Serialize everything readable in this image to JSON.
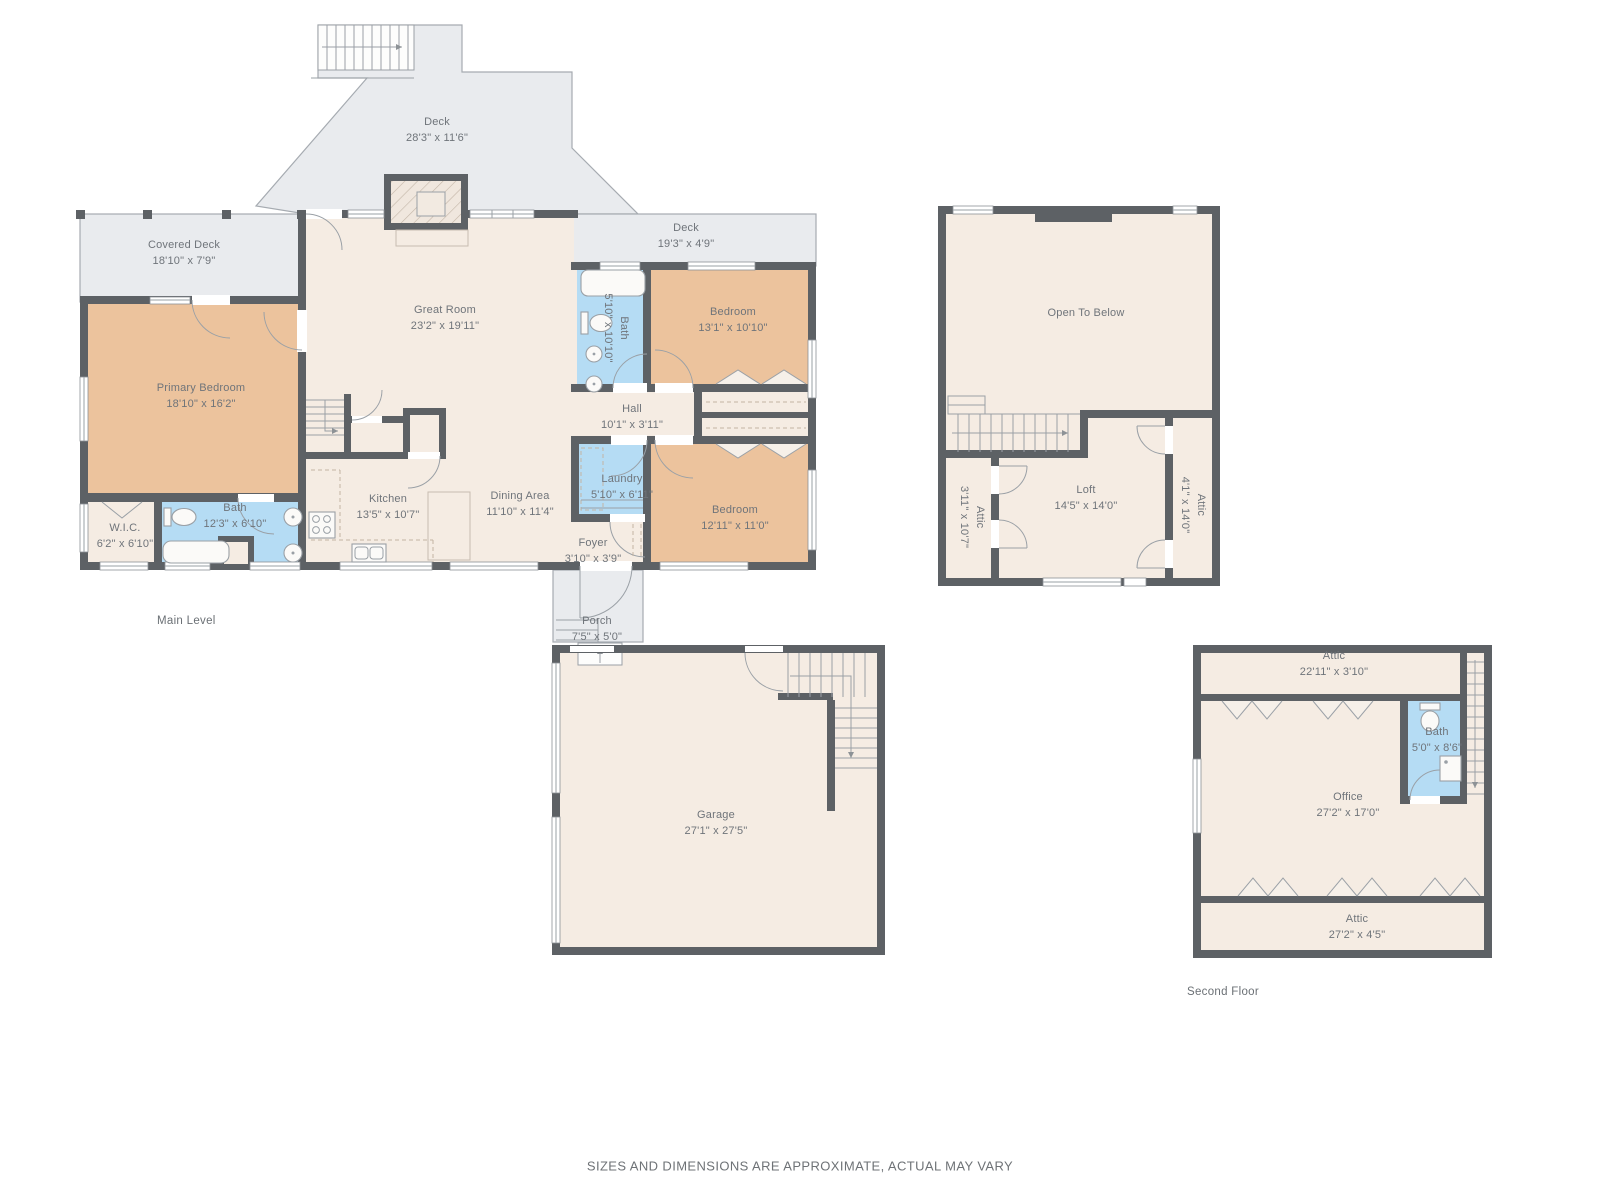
{
  "palette": {
    "wall": "#5d6165",
    "room_fill": "#f5ece3",
    "bedroom_fill": "#ecc39d",
    "bath_fill": "#b5dcf4",
    "deck_fill": "#e9ebee",
    "line": "#9aa0a6",
    "label_text": "#6f747a"
  },
  "plans": {
    "main": {
      "level_label": "Main Level",
      "rooms": {
        "deck_top": {
          "name": "Deck",
          "dims": "28'3\" x 11'6\""
        },
        "deck_right": {
          "name": "Deck",
          "dims": "19'3\" x 4'9\""
        },
        "covered_deck": {
          "name": "Covered Deck",
          "dims": "18'10\" x 7'9\""
        },
        "primary_bedroom": {
          "name": "Primary Bedroom",
          "dims": "18'10\" x 16'2\""
        },
        "great_room": {
          "name": "Great Room",
          "dims": "23'2\" x 19'11\""
        },
        "hall_bath": {
          "name": "Bath",
          "dims": "5'10\" x 10'10\""
        },
        "bedroom_top": {
          "name": "Bedroom",
          "dims": "13'1\" x 10'10\""
        },
        "hall": {
          "name": "Hall",
          "dims": "10'1\" x 3'11\""
        },
        "wic": {
          "name": "W.I.C.",
          "dims": "6'2\" x 6'10\""
        },
        "primary_bath": {
          "name": "Bath",
          "dims": "12'3\" x 6'10\""
        },
        "kitchen": {
          "name": "Kitchen",
          "dims": "13'5\" x 10'7\""
        },
        "dining": {
          "name": "Dining Area",
          "dims": "11'10\" x 11'4\""
        },
        "laundry": {
          "name": "Laundry",
          "dims": "5'10\" x 6'11\""
        },
        "bedroom_bottom": {
          "name": "Bedroom",
          "dims": "12'11\" x 11'0\""
        },
        "foyer": {
          "name": "Foyer",
          "dims": "3'10\" x 3'9\""
        },
        "porch": {
          "name": "Porch",
          "dims": "7'5\" x 5'0\""
        },
        "garage": {
          "name": "Garage",
          "dims": "27'1\" x 27'5\""
        }
      }
    },
    "loft": {
      "rooms": {
        "open_to_below": {
          "name": "Open To Below",
          "dims": ""
        },
        "attic_left": {
          "name": "Attic",
          "dims": "3'11\" x 10'7\""
        },
        "loft": {
          "name": "Loft",
          "dims": "14'5\" x 14'0\""
        },
        "attic_right": {
          "name": "Attic",
          "dims": "4'1\" x 14'0\""
        }
      }
    },
    "second": {
      "level_label": "Second Floor",
      "rooms": {
        "attic_top": {
          "name": "Attic",
          "dims": "22'11\" x 3'10\""
        },
        "bath": {
          "name": "Bath",
          "dims": "5'0\" x 8'6\""
        },
        "office": {
          "name": "Office",
          "dims": "27'2\" x 17'0\""
        },
        "attic_bottom": {
          "name": "Attic",
          "dims": "27'2\" x 4'5\""
        }
      }
    }
  },
  "footer": {
    "disclaimer": "SIZES AND DIMENSIONS ARE APPROXIMATE, ACTUAL MAY VARY"
  }
}
